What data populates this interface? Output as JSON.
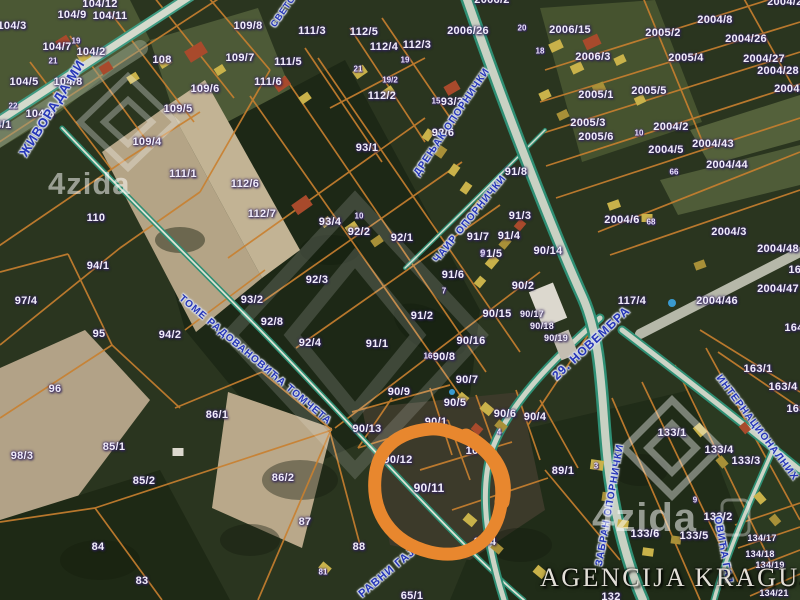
{
  "map": {
    "attribution": "AGENCIJA KRAGUJSTAN",
    "watermark": {
      "brand": "4zida"
    },
    "highlight": {
      "parcel": "90/11",
      "color": "#e8872e"
    },
    "colors": {
      "parcel_line": "#c9802f",
      "road_edge": "#2f8f74",
      "street_text": "#2636b8",
      "label_text": "#f1edfb"
    },
    "street_labels": [
      {
        "t": "ЖИВОРАДА МИ",
        "x": 52,
        "y": 108,
        "r": -58,
        "s": 13
      },
      {
        "t": "СВЕТО",
        "x": 283,
        "y": 11,
        "r": -55,
        "s": 9
      },
      {
        "t": "ДРЕЊАК ОПОРНИЧКИ",
        "x": 452,
        "y": 122,
        "r": -56,
        "s": 10
      },
      {
        "t": "ЧАИР ОПОРНИЧКИ",
        "x": 470,
        "y": 219,
        "r": -51,
        "s": 10
      },
      {
        "t": "ТОМЕ РАДОВАНОВИЋА ТОМЧЕТА",
        "x": 255,
        "y": 360,
        "r": 40,
        "s": 10
      },
      {
        "t": "29. НОВЕМБРА",
        "x": 591,
        "y": 343,
        "r": -43,
        "s": 12
      },
      {
        "t": "ЗАБРАН ОПОРНИЧКИ",
        "x": 610,
        "y": 505,
        "r": -80,
        "s": 10
      },
      {
        "t": "РАВНИ ГАЈ",
        "x": 387,
        "y": 573,
        "r": -40,
        "s": 11
      },
      {
        "t": "ИНТЕРНАЦИОНАЛНИХ",
        "x": 757,
        "y": 428,
        "r": 53,
        "s": 10
      },
      {
        "t": "ОВИЋА ГАЈ",
        "x": 723,
        "y": 550,
        "r": 80,
        "s": 10
      }
    ],
    "parcel_labels": [
      {
        "t": "104/12",
        "x": 100,
        "y": 4
      },
      {
        "t": "104/9",
        "x": 72,
        "y": 15
      },
      {
        "t": "104/11",
        "x": 110,
        "y": 16
      },
      {
        "t": "104/3",
        "x": 12,
        "y": 26
      },
      {
        "t": "104/7",
        "x": 57,
        "y": 47
      },
      {
        "t": "104/2",
        "x": 91,
        "y": 52
      },
      {
        "t": "108",
        "x": 162,
        "y": 60
      },
      {
        "t": "104/5",
        "x": 24,
        "y": 82
      },
      {
        "t": "104/8",
        "x": 68,
        "y": 82
      },
      {
        "t": "104/6",
        "x": 40,
        "y": 114
      },
      {
        "t": "104/1",
        "x": -3,
        "y": 125
      },
      {
        "t": "109/8",
        "x": 248,
        "y": 26
      },
      {
        "t": "109/7",
        "x": 240,
        "y": 58
      },
      {
        "t": "109/6",
        "x": 205,
        "y": 89
      },
      {
        "t": "109/5",
        "x": 178,
        "y": 109
      },
      {
        "t": "109/4",
        "x": 147,
        "y": 142
      },
      {
        "t": "111/1",
        "x": 183,
        "y": 174
      },
      {
        "t": "112/6",
        "x": 245,
        "y": 184
      },
      {
        "t": "110",
        "x": 96,
        "y": 218
      },
      {
        "t": "94/1",
        "x": 98,
        "y": 266
      },
      {
        "t": "97/4",
        "x": 26,
        "y": 301
      },
      {
        "t": "95",
        "x": 99,
        "y": 334
      },
      {
        "t": "94/2",
        "x": 170,
        "y": 335
      },
      {
        "t": "96",
        "x": 55,
        "y": 389
      },
      {
        "t": "98/3",
        "x": 22,
        "y": 456
      },
      {
        "t": "85/1",
        "x": 114,
        "y": 447
      },
      {
        "t": "85/2",
        "x": 144,
        "y": 481
      },
      {
        "t": "86/1",
        "x": 217,
        "y": 415
      },
      {
        "t": "86/2",
        "x": 283,
        "y": 478
      },
      {
        "t": "84",
        "x": 98,
        "y": 547
      },
      {
        "t": "83",
        "x": 142,
        "y": 581
      },
      {
        "t": "87",
        "x": 305,
        "y": 522
      },
      {
        "t": "88",
        "x": 359,
        "y": 547
      },
      {
        "t": "65/1",
        "x": 412,
        "y": 596
      },
      {
        "t": "111/3",
        "x": 312,
        "y": 31
      },
      {
        "t": "112/5",
        "x": 364,
        "y": 32
      },
      {
        "t": "112/4",
        "x": 384,
        "y": 47
      },
      {
        "t": "112/3",
        "x": 417,
        "y": 45
      },
      {
        "t": "111/5",
        "x": 288,
        "y": 62
      },
      {
        "t": "111/6",
        "x": 268,
        "y": 82
      },
      {
        "t": "112/2",
        "x": 382,
        "y": 96
      },
      {
        "t": "112/7",
        "x": 262,
        "y": 214
      },
      {
        "t": "2006/26",
        "x": 468,
        "y": 31
      },
      {
        "t": "2006/2",
        "x": 492,
        "y": 0
      },
      {
        "t": "2006/15",
        "x": 570,
        "y": 30
      },
      {
        "t": "2006/3",
        "x": 593,
        "y": 57
      },
      {
        "t": "2005/2",
        "x": 663,
        "y": 33
      },
      {
        "t": "2005/4",
        "x": 686,
        "y": 58
      },
      {
        "t": "2005/1",
        "x": 596,
        "y": 95
      },
      {
        "t": "2005/5",
        "x": 649,
        "y": 91
      },
      {
        "t": "2005/3",
        "x": 588,
        "y": 123
      },
      {
        "t": "2005/6",
        "x": 596,
        "y": 137
      },
      {
        "t": "2004/8",
        "x": 715,
        "y": 20
      },
      {
        "t": "2004/26",
        "x": 746,
        "y": 39
      },
      {
        "t": "2004/27",
        "x": 764,
        "y": 59
      },
      {
        "t": "2004/28",
        "x": 778,
        "y": 71
      },
      {
        "t": "2004/29",
        "x": 795,
        "y": 89
      },
      {
        "t": "2004/25",
        "x": 788,
        "y": 2
      },
      {
        "t": "2004/2",
        "x": 671,
        "y": 127
      },
      {
        "t": "2004/5",
        "x": 666,
        "y": 150
      },
      {
        "t": "2004/43",
        "x": 713,
        "y": 144
      },
      {
        "t": "2004/44",
        "x": 727,
        "y": 165
      },
      {
        "t": "2004/6",
        "x": 622,
        "y": 220
      },
      {
        "t": "2004/3",
        "x": 729,
        "y": 232
      },
      {
        "t": "2004/48",
        "x": 778,
        "y": 249
      },
      {
        "t": "2004/47",
        "x": 778,
        "y": 289
      },
      {
        "t": "2004/46",
        "x": 717,
        "y": 301
      },
      {
        "t": "117/4",
        "x": 632,
        "y": 301
      },
      {
        "t": "90/14",
        "x": 548,
        "y": 251
      },
      {
        "t": "93/3",
        "x": 452,
        "y": 102
      },
      {
        "t": "92/6",
        "x": 443,
        "y": 133
      },
      {
        "t": "93/1",
        "x": 367,
        "y": 148
      },
      {
        "t": "93/4",
        "x": 330,
        "y": 222
      },
      {
        "t": "92/2",
        "x": 359,
        "y": 232
      },
      {
        "t": "92/1",
        "x": 402,
        "y": 238
      },
      {
        "t": "92/3",
        "x": 317,
        "y": 280
      },
      {
        "t": "93/2",
        "x": 252,
        "y": 300
      },
      {
        "t": "92/8",
        "x": 272,
        "y": 322
      },
      {
        "t": "92/4",
        "x": 310,
        "y": 343
      },
      {
        "t": "91/1",
        "x": 377,
        "y": 344
      },
      {
        "t": "91/2",
        "x": 422,
        "y": 316
      },
      {
        "t": "91/6",
        "x": 453,
        "y": 275
      },
      {
        "t": "91/7",
        "x": 478,
        "y": 237
      },
      {
        "t": "91/5",
        "x": 491,
        "y": 254
      },
      {
        "t": "91/3",
        "x": 520,
        "y": 216
      },
      {
        "t": "91/4",
        "x": 509,
        "y": 236
      },
      {
        "t": "91/8",
        "x": 516,
        "y": 172
      },
      {
        "t": "90/2",
        "x": 523,
        "y": 286
      },
      {
        "t": "90/15",
        "x": 497,
        "y": 314
      },
      {
        "t": "90/16",
        "x": 471,
        "y": 341
      },
      {
        "t": "90/8",
        "x": 444,
        "y": 357
      },
      {
        "t": "90/7",
        "x": 467,
        "y": 380
      },
      {
        "t": "90/9",
        "x": 399,
        "y": 392
      },
      {
        "t": "90/17",
        "x": 532,
        "y": 314,
        "s": 9
      },
      {
        "t": "90/18",
        "x": 542,
        "y": 326,
        "s": 9
      },
      {
        "t": "90/19",
        "x": 556,
        "y": 338,
        "s": 9
      },
      {
        "t": "90/13",
        "x": 367,
        "y": 429
      },
      {
        "t": "90/1",
        "x": 436,
        "y": 422
      },
      {
        "t": "90/5",
        "x": 455,
        "y": 403
      },
      {
        "t": "90/6",
        "x": 505,
        "y": 414
      },
      {
        "t": "90/4",
        "x": 535,
        "y": 417
      },
      {
        "t": "90/12",
        "x": 398,
        "y": 460
      },
      {
        "t": "10",
        "x": 472,
        "y": 451
      },
      {
        "t": "90/11",
        "x": 429,
        "y": 488,
        "s": 12
      },
      {
        "t": "89/4",
        "x": 485,
        "y": 542
      },
      {
        "t": "89/1",
        "x": 563,
        "y": 471
      },
      {
        "t": "133/1",
        "x": 672,
        "y": 433
      },
      {
        "t": "133/4",
        "x": 719,
        "y": 450
      },
      {
        "t": "133/3",
        "x": 746,
        "y": 461
      },
      {
        "t": "133/2",
        "x": 718,
        "y": 517
      },
      {
        "t": "133/6",
        "x": 645,
        "y": 534
      },
      {
        "t": "133/5",
        "x": 694,
        "y": 536
      },
      {
        "t": "134/17",
        "x": 762,
        "y": 538,
        "s": 9
      },
      {
        "t": "134/18",
        "x": 760,
        "y": 554,
        "s": 9
      },
      {
        "t": "134/19",
        "x": 770,
        "y": 565,
        "s": 9
      },
      {
        "t": "134/21",
        "x": 774,
        "y": 593,
        "s": 9
      },
      {
        "t": "163/1",
        "x": 758,
        "y": 369
      },
      {
        "t": "163/4",
        "x": 783,
        "y": 387
      },
      {
        "t": "163",
        "x": 796,
        "y": 409
      },
      {
        "t": "164",
        "x": 794,
        "y": 328
      },
      {
        "t": "163",
        "x": 798,
        "y": 270
      },
      {
        "t": "132",
        "x": 611,
        "y": 597
      }
    ],
    "house_numbers": [
      {
        "t": "19",
        "x": 76,
        "y": 41
      },
      {
        "t": "21",
        "x": 53,
        "y": 61
      },
      {
        "t": "22",
        "x": 13,
        "y": 106
      },
      {
        "t": "20",
        "x": 522,
        "y": 28
      },
      {
        "t": "18",
        "x": 540,
        "y": 51
      },
      {
        "t": "21",
        "x": 358,
        "y": 69
      },
      {
        "t": "19",
        "x": 405,
        "y": 60
      },
      {
        "t": "19/2",
        "x": 390,
        "y": 80
      },
      {
        "t": "15",
        "x": 436,
        "y": 101
      },
      {
        "t": "10",
        "x": 359,
        "y": 216
      },
      {
        "t": "7",
        "x": 444,
        "y": 291
      },
      {
        "t": "9",
        "x": 483,
        "y": 253
      },
      {
        "t": "10",
        "x": 639,
        "y": 133
      },
      {
        "t": "66",
        "x": 674,
        "y": 172
      },
      {
        "t": "68",
        "x": 651,
        "y": 222
      },
      {
        "t": "16",
        "x": 428,
        "y": 356
      },
      {
        "t": "8",
        "x": 474,
        "y": 439
      },
      {
        "t": "4",
        "x": 499,
        "y": 432
      },
      {
        "t": "3",
        "x": 596,
        "y": 466
      },
      {
        "t": "9",
        "x": 695,
        "y": 500
      },
      {
        "t": "81",
        "x": 323,
        "y": 572
      }
    ]
  }
}
